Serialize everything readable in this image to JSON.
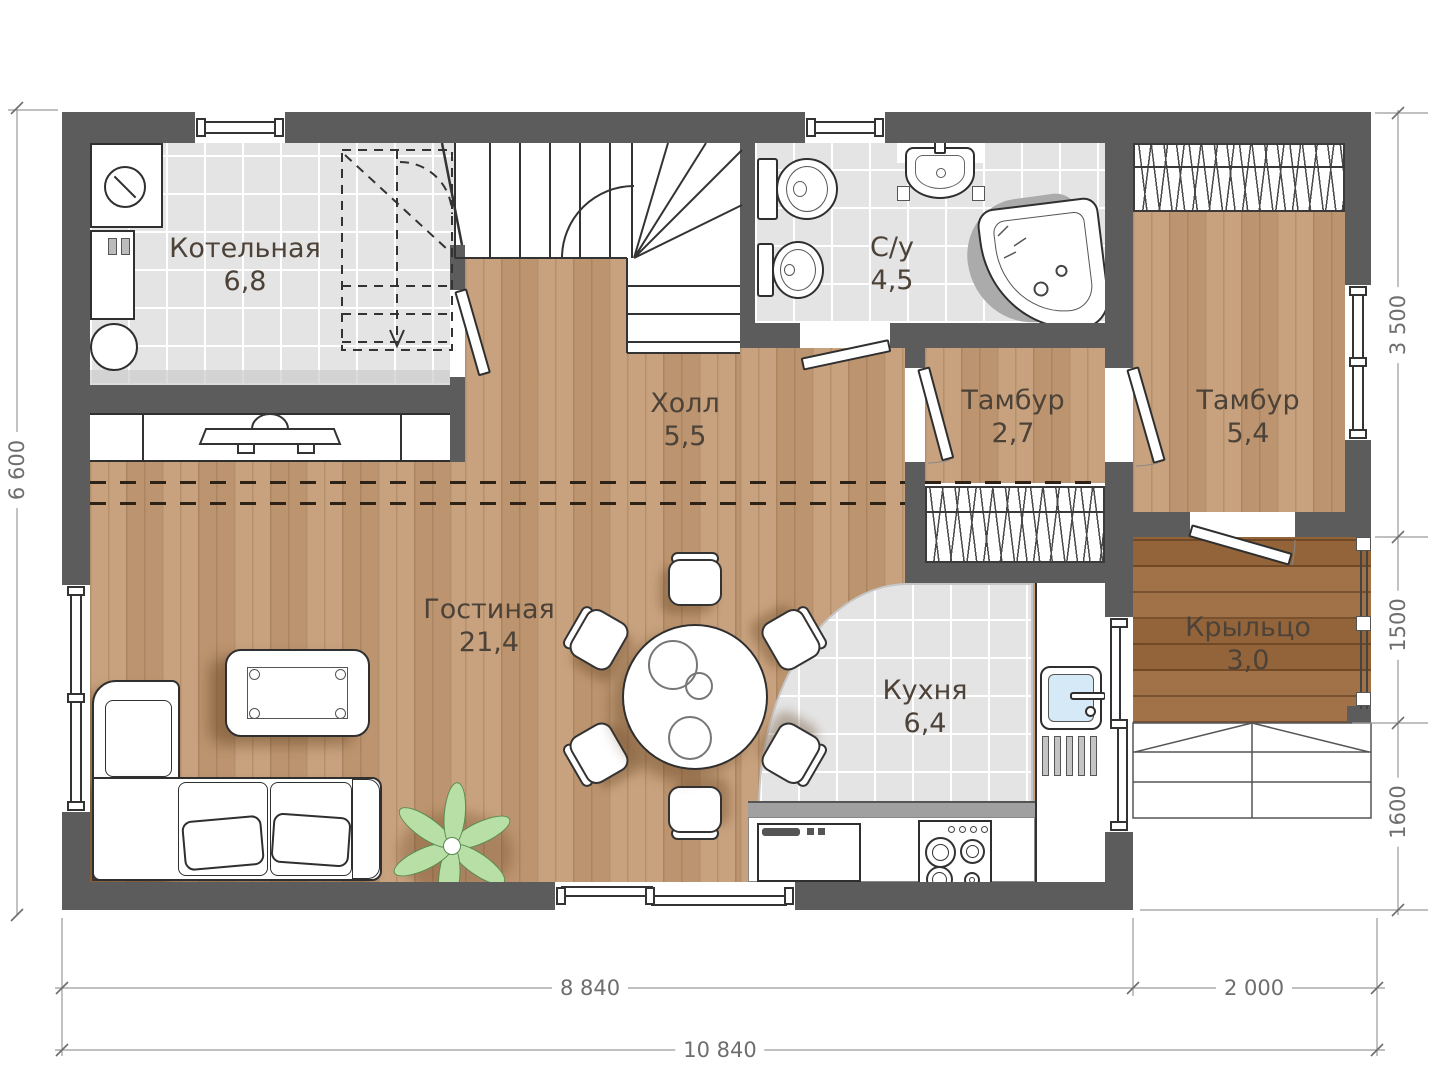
{
  "rooms": [
    {
      "id": "kotelnaya",
      "name": "Котельная",
      "area": "6,8"
    },
    {
      "id": "su",
      "name": "С/у",
      "area": "4,5"
    },
    {
      "id": "holl",
      "name": "Холл",
      "area": "5,5"
    },
    {
      "id": "tambur-small",
      "name": "Тамбур",
      "area": "2,7"
    },
    {
      "id": "tambur-big",
      "name": "Тамбур",
      "area": "5,4"
    },
    {
      "id": "gostinaya",
      "name": "Гостиная",
      "area": "21,4"
    },
    {
      "id": "kuhnya",
      "name": "Кухня",
      "area": "6,4"
    },
    {
      "id": "krylco",
      "name": "Крыльцо",
      "area": "3,0"
    }
  ],
  "dimensions": {
    "left_height": "6 600",
    "right_top": "3 500",
    "right_middle": "1500",
    "right_bottom": "1600",
    "bottom_main": "8 840",
    "bottom_porch": "2 000",
    "bottom_total": "10 840"
  },
  "colors": {
    "wall": "#5c5c5c",
    "wood": "#c49b74",
    "wood-dark": "#9c6a3e",
    "tile": "#e4e4e4",
    "line": "#2f2f2f",
    "label": "#4c4238",
    "dim": "#6e6e6e",
    "plant": "#b7dfa6",
    "plant-stroke": "#5a8a50",
    "sink-blue": "#d6e9f6"
  }
}
